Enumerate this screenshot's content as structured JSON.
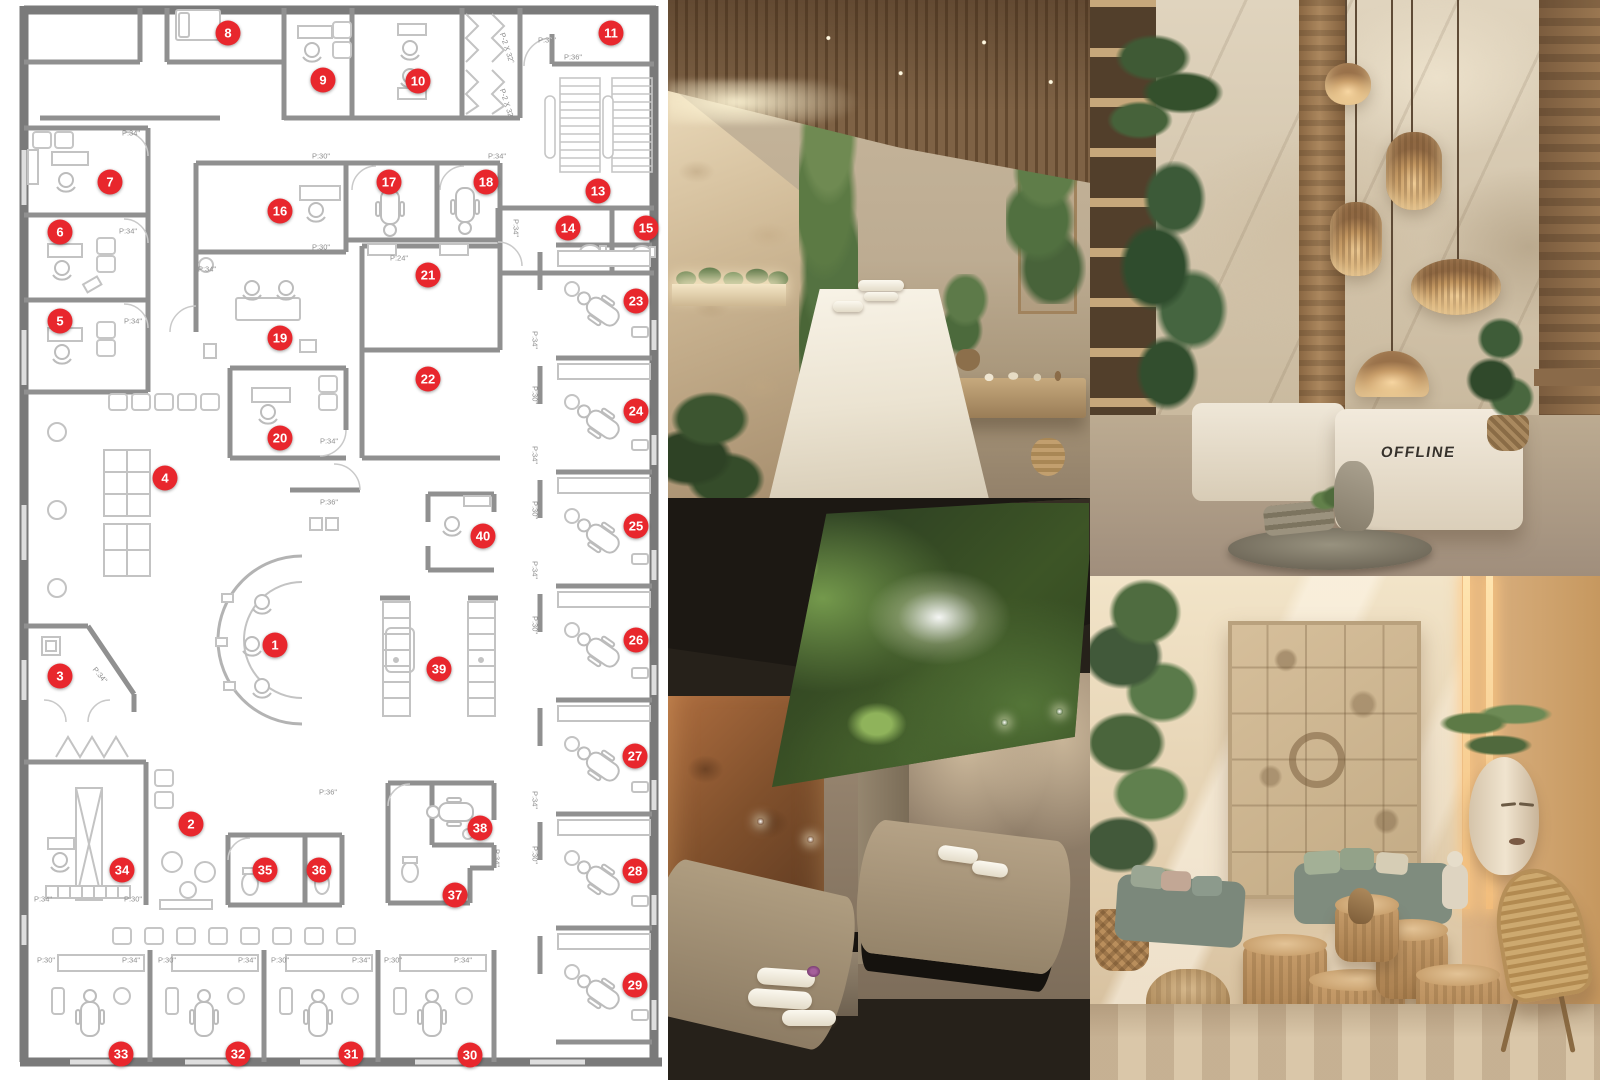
{
  "board": {
    "type": "spa-dental-clinic-design-board"
  },
  "accent_color": "#e8272d",
  "floorplan": {
    "wall_color": "#8f8f8f",
    "marker_color": "#e8272d",
    "markers": [
      {
        "n": "1",
        "x": 275,
        "y": 645
      },
      {
        "n": "2",
        "x": 191,
        "y": 824
      },
      {
        "n": "3",
        "x": 60,
        "y": 676
      },
      {
        "n": "4",
        "x": 165,
        "y": 478
      },
      {
        "n": "5",
        "x": 60,
        "y": 321
      },
      {
        "n": "6",
        "x": 60,
        "y": 232
      },
      {
        "n": "7",
        "x": 110,
        "y": 182
      },
      {
        "n": "8",
        "x": 228,
        "y": 33
      },
      {
        "n": "9",
        "x": 323,
        "y": 80
      },
      {
        "n": "10",
        "x": 418,
        "y": 81
      },
      {
        "n": "11",
        "x": 611,
        "y": 33
      },
      {
        "n": "13",
        "x": 598,
        "y": 191
      },
      {
        "n": "14",
        "x": 568,
        "y": 228
      },
      {
        "n": "15",
        "x": 646,
        "y": 228
      },
      {
        "n": "16",
        "x": 280,
        "y": 211
      },
      {
        "n": "17",
        "x": 389,
        "y": 182
      },
      {
        "n": "18",
        "x": 486,
        "y": 182
      },
      {
        "n": "19",
        "x": 280,
        "y": 338
      },
      {
        "n": "20",
        "x": 280,
        "y": 438
      },
      {
        "n": "21",
        "x": 428,
        "y": 275
      },
      {
        "n": "22",
        "x": 428,
        "y": 379
      },
      {
        "n": "23",
        "x": 636,
        "y": 301
      },
      {
        "n": "24",
        "x": 636,
        "y": 411
      },
      {
        "n": "25",
        "x": 636,
        "y": 526
      },
      {
        "n": "26",
        "x": 636,
        "y": 640
      },
      {
        "n": "27",
        "x": 635,
        "y": 756
      },
      {
        "n": "28",
        "x": 635,
        "y": 871
      },
      {
        "n": "29",
        "x": 635,
        "y": 985
      },
      {
        "n": "30",
        "x": 470,
        "y": 1055
      },
      {
        "n": "31",
        "x": 351,
        "y": 1054
      },
      {
        "n": "32",
        "x": 238,
        "y": 1054
      },
      {
        "n": "33",
        "x": 121,
        "y": 1054
      },
      {
        "n": "34",
        "x": 122,
        "y": 870
      },
      {
        "n": "35",
        "x": 265,
        "y": 870
      },
      {
        "n": "36",
        "x": 319,
        "y": 870
      },
      {
        "n": "37",
        "x": 455,
        "y": 895
      },
      {
        "n": "38",
        "x": 480,
        "y": 828
      },
      {
        "n": "39",
        "x": 439,
        "y": 669
      },
      {
        "n": "40",
        "x": 483,
        "y": 536
      }
    ],
    "dimension_labels": [
      {
        "text": "P:34\"",
        "x": 131,
        "y": 133,
        "rot": 0
      },
      {
        "text": "P:30\"",
        "x": 321,
        "y": 156,
        "rot": 0
      },
      {
        "text": "P:34\"",
        "x": 128,
        "y": 231,
        "rot": 0
      },
      {
        "text": "P:30\"",
        "x": 321,
        "y": 247,
        "rot": 0
      },
      {
        "text": "P:34\"",
        "x": 207,
        "y": 269,
        "rot": 0
      },
      {
        "text": "P:24\"",
        "x": 399,
        "y": 258,
        "rot": 0
      },
      {
        "text": "P:36\"",
        "x": 547,
        "y": 40,
        "rot": 0
      },
      {
        "text": "P:36\"",
        "x": 573,
        "y": 57,
        "rot": 0
      },
      {
        "text": "P:34\"",
        "x": 497,
        "y": 156,
        "rot": 0
      },
      {
        "text": "P:34\"",
        "x": 133,
        "y": 321,
        "rot": 0
      },
      {
        "text": "P:34\"",
        "x": 329,
        "y": 441,
        "rot": 0
      },
      {
        "text": "P:36\"",
        "x": 329,
        "y": 502,
        "rot": 0
      },
      {
        "text": "P:34\"",
        "x": 100,
        "y": 675,
        "rot": 50
      },
      {
        "text": "P:36\"",
        "x": 328,
        "y": 792,
        "rot": 0
      },
      {
        "text": "P:34\"",
        "x": 43,
        "y": 899,
        "rot": 0
      },
      {
        "text": "P:30\"",
        "x": 133,
        "y": 899,
        "rot": 0
      },
      {
        "text": "P:30\"",
        "x": 46,
        "y": 960,
        "rot": 0
      },
      {
        "text": "P:34\"",
        "x": 131,
        "y": 960,
        "rot": 0
      },
      {
        "text": "P:30\"",
        "x": 167,
        "y": 960,
        "rot": 0
      },
      {
        "text": "P:34\"",
        "x": 247,
        "y": 960,
        "rot": 0
      },
      {
        "text": "P:30\"",
        "x": 280,
        "y": 960,
        "rot": 0
      },
      {
        "text": "P:34\"",
        "x": 361,
        "y": 960,
        "rot": 0
      },
      {
        "text": "P:30\"",
        "x": 393,
        "y": 960,
        "rot": 0
      },
      {
        "text": "P:34\"",
        "x": 463,
        "y": 960,
        "rot": 0
      },
      {
        "text": "P-2 X 32\"",
        "x": 507,
        "y": 48,
        "rot": 72
      },
      {
        "text": "P-2 X 32\"",
        "x": 507,
        "y": 104,
        "rot": 72
      },
      {
        "text": "P:34\"",
        "x": 535,
        "y": 340,
        "rot": 90
      },
      {
        "text": "P:30\"",
        "x": 535,
        "y": 395,
        "rot": 90
      },
      {
        "text": "P:34\"",
        "x": 535,
        "y": 455,
        "rot": 90
      },
      {
        "text": "P:30\"",
        "x": 535,
        "y": 510,
        "rot": 90
      },
      {
        "text": "P:34\"",
        "x": 535,
        "y": 570,
        "rot": 90
      },
      {
        "text": "P:30\"",
        "x": 535,
        "y": 625,
        "rot": 90
      },
      {
        "text": "P:34\"",
        "x": 535,
        "y": 800,
        "rot": 90
      },
      {
        "text": "P:30\"",
        "x": 535,
        "y": 855,
        "rot": 90
      },
      {
        "text": "P:34\"",
        "x": 516,
        "y": 228,
        "rot": 90
      },
      {
        "text": "P:34\"",
        "x": 497,
        "y": 858,
        "rot": 90
      }
    ]
  },
  "photos": {
    "spa_room": {
      "subject": "Massage treatment room with wood slat ceiling, lit stone wall and living green wall"
    },
    "reception": {
      "subject": "Reception lobby with rugged stone wall, woven pendant lamps and stone desk",
      "desk_logo": "OFFLINE"
    },
    "skylight_room": {
      "subject": "Couples massage room with forest canopy skylight and cork wall"
    },
    "lounge": {
      "subject": "Lounge with carved relief wall panel, sage sofa, wooden stools and rattan chair"
    }
  }
}
